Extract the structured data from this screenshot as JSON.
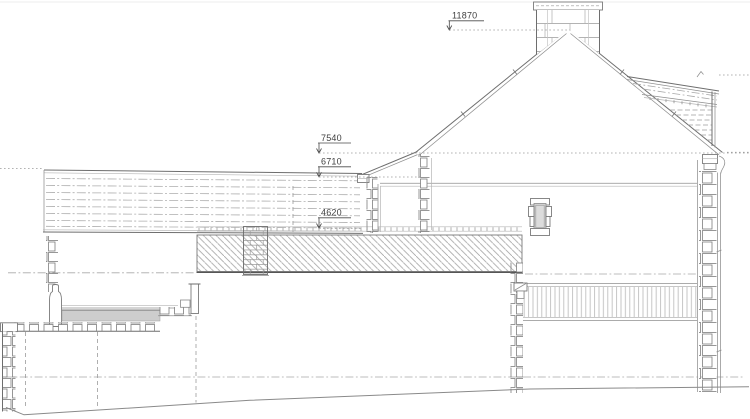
{
  "drawing": {
    "dimensions": {
      "ridge": {
        "label": "11870"
      },
      "main_eaves": {
        "label": "7540"
      },
      "lower_eaves": {
        "label": "6710"
      },
      "flat_roof": {
        "label": "4620"
      }
    },
    "colors": {
      "background": "#ffffff",
      "line": "#6e6e6e",
      "light_line": "#adadad",
      "hatch": "#a6a6a6",
      "text": "#3f3f3f",
      "slab_fill": "#cdcdcd",
      "glazing_fill": "#d4d4d4"
    }
  }
}
